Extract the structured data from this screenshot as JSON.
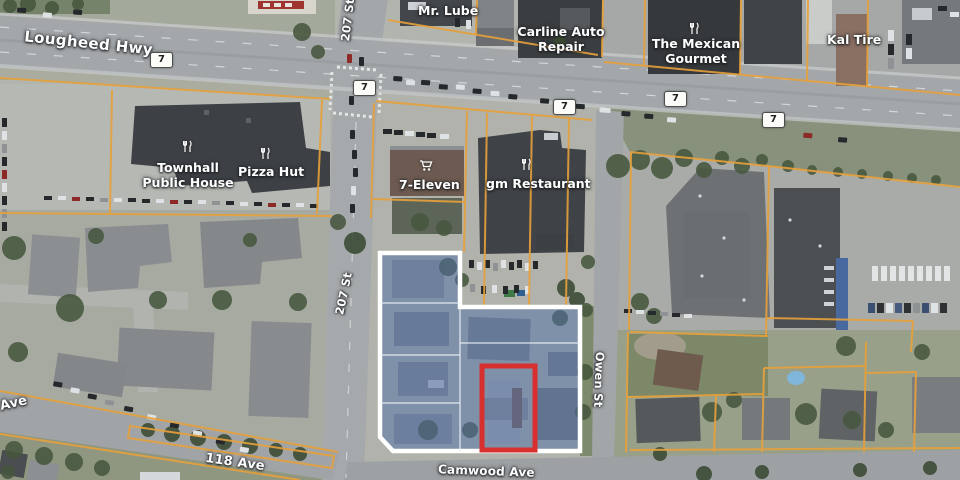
{
  "map": {
    "shield_label": "7",
    "streets": {
      "lougheed_hwy": "Lougheed Hwy",
      "st_207_top": "207 St",
      "st_207": "207 St",
      "owen_st": "Owen St",
      "ave_118": "118 Ave",
      "ave_118_west": "Ave",
      "camwood_ave": "Camwood Ave"
    },
    "places": {
      "mr_lube": "Mr. Lube",
      "carline_auto_repair": [
        "Carline Auto",
        "Repair"
      ],
      "the_mexican_gourmet": [
        "The Mexican",
        "Gourmet"
      ],
      "kal_tire": "Kal Tire",
      "townhall_public_house": [
        "Townhall",
        "Public House"
      ],
      "pizza_hut": "Pizza Hut",
      "seven_eleven": "7-Eleven",
      "gm_restaurant": "gm Restaurant"
    },
    "overlay": {
      "selection_outline_color": "#ffffff",
      "selection_fill_color": "rgba(78,110,168,0.5)",
      "highlight_color": "#d7302e",
      "parcel_line_color": "#e7a13b"
    }
  }
}
